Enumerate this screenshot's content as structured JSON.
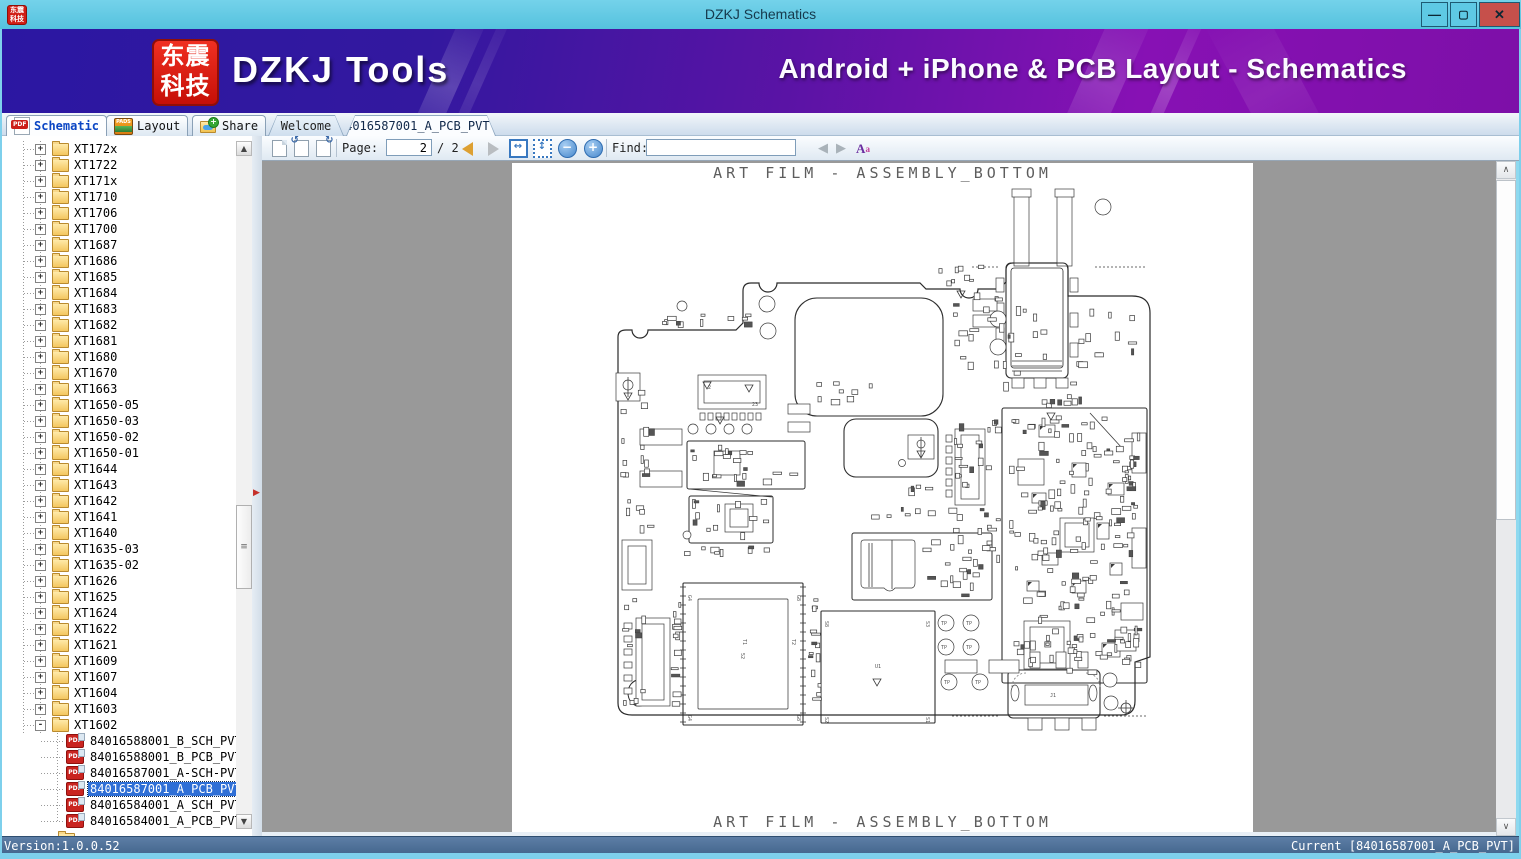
{
  "window": {
    "title": "DZKJ Schematics",
    "logo_line1": "东震",
    "logo_line2": "科技"
  },
  "banner": {
    "brand": "DZKJ Tools",
    "tagline": "Android + iPhone & PCB Layout - Schematics"
  },
  "tabs": {
    "function": [
      {
        "label": "Schematic",
        "icon": "pdf-icon",
        "active": true
      },
      {
        "label": "Layout",
        "icon": "pads-icon",
        "active": false
      },
      {
        "label": "Share",
        "icon": "share-folder-icon",
        "active": false
      }
    ],
    "documents": [
      {
        "label": "Welcome",
        "active": false
      },
      {
        "label": "84016587001_A_PCB_PVT",
        "active": true,
        "closable": true
      }
    ]
  },
  "toolbar": {
    "page_label": "Page:",
    "page_value": "2",
    "page_total": "/ 2",
    "find_label": "Find:",
    "find_value": ""
  },
  "tree": {
    "folders": [
      "XT172x",
      "XT1722",
      "XT171x",
      "XT1710",
      "XT1706",
      "XT1700",
      "XT1687",
      "XT1686",
      "XT1685",
      "XT1684",
      "XT1683",
      "XT1682",
      "XT1681",
      "XT1680",
      "XT1670",
      "XT1663",
      "XT1650-05",
      "XT1650-03",
      "XT1650-02",
      "XT1650-01",
      "XT1644",
      "XT1643",
      "XT1642",
      "XT1641",
      "XT1640",
      "XT1635-03",
      "XT1635-02",
      "XT1626",
      "XT1625",
      "XT1624",
      "XT1622",
      "XT1621",
      "XT1609",
      "XT1607",
      "XT1604",
      "XT1603",
      "XT1602"
    ],
    "expanded_folder": "XT1602",
    "files": [
      "84016588001_B_SCH_PVT",
      "84016588001_B_PCB_PVT",
      "84016587001_A-SCH-PVT",
      "84016587001_A_PCB_PVT",
      "84016584001_A_SCH_PVT",
      "84016584001_A_PCB_PVT"
    ],
    "selected_index": 3
  },
  "viewer": {
    "page_title_top": "ART FILM - ASSEMBLY_BOTTOM",
    "page_title_bottom": "ART FILM - ASSEMBLY_BOTTOM"
  },
  "statusbar": {
    "version": "Version:1.0.0.52",
    "current": "Current [84016587001_A_PCB_PVT]"
  },
  "icons": {
    "minimize": "—",
    "maximize": "▢",
    "close": "✕",
    "tab_close": "✕",
    "plus": "+",
    "minus": "-",
    "prev_page": "",
    "next_page": "",
    "fit_width": "↔",
    "fit_page": "↕",
    "zoom_out": "−",
    "zoom_in": "+",
    "find_prev": "◀",
    "find_next": "▶",
    "case_A": "A",
    "case_a": "a",
    "rotate_left": "↺",
    "rotate_right": "↻",
    "chevron_up": "∧",
    "chevron_down": "∨",
    "arrow_up": "▲",
    "arrow_down": "▼",
    "splitter_arrow": "▶",
    "pdf_label": "PDF",
    "pads_label": "PADS"
  },
  "colors": {
    "titlebar": "#5cc6e3",
    "close_button": "#c6504b",
    "banner_left": "#2b17a2",
    "banner_right": "#8711b4",
    "selection": "#2f6fd6",
    "viewer_background": "#999999",
    "statusbar": "#4a6c94"
  }
}
